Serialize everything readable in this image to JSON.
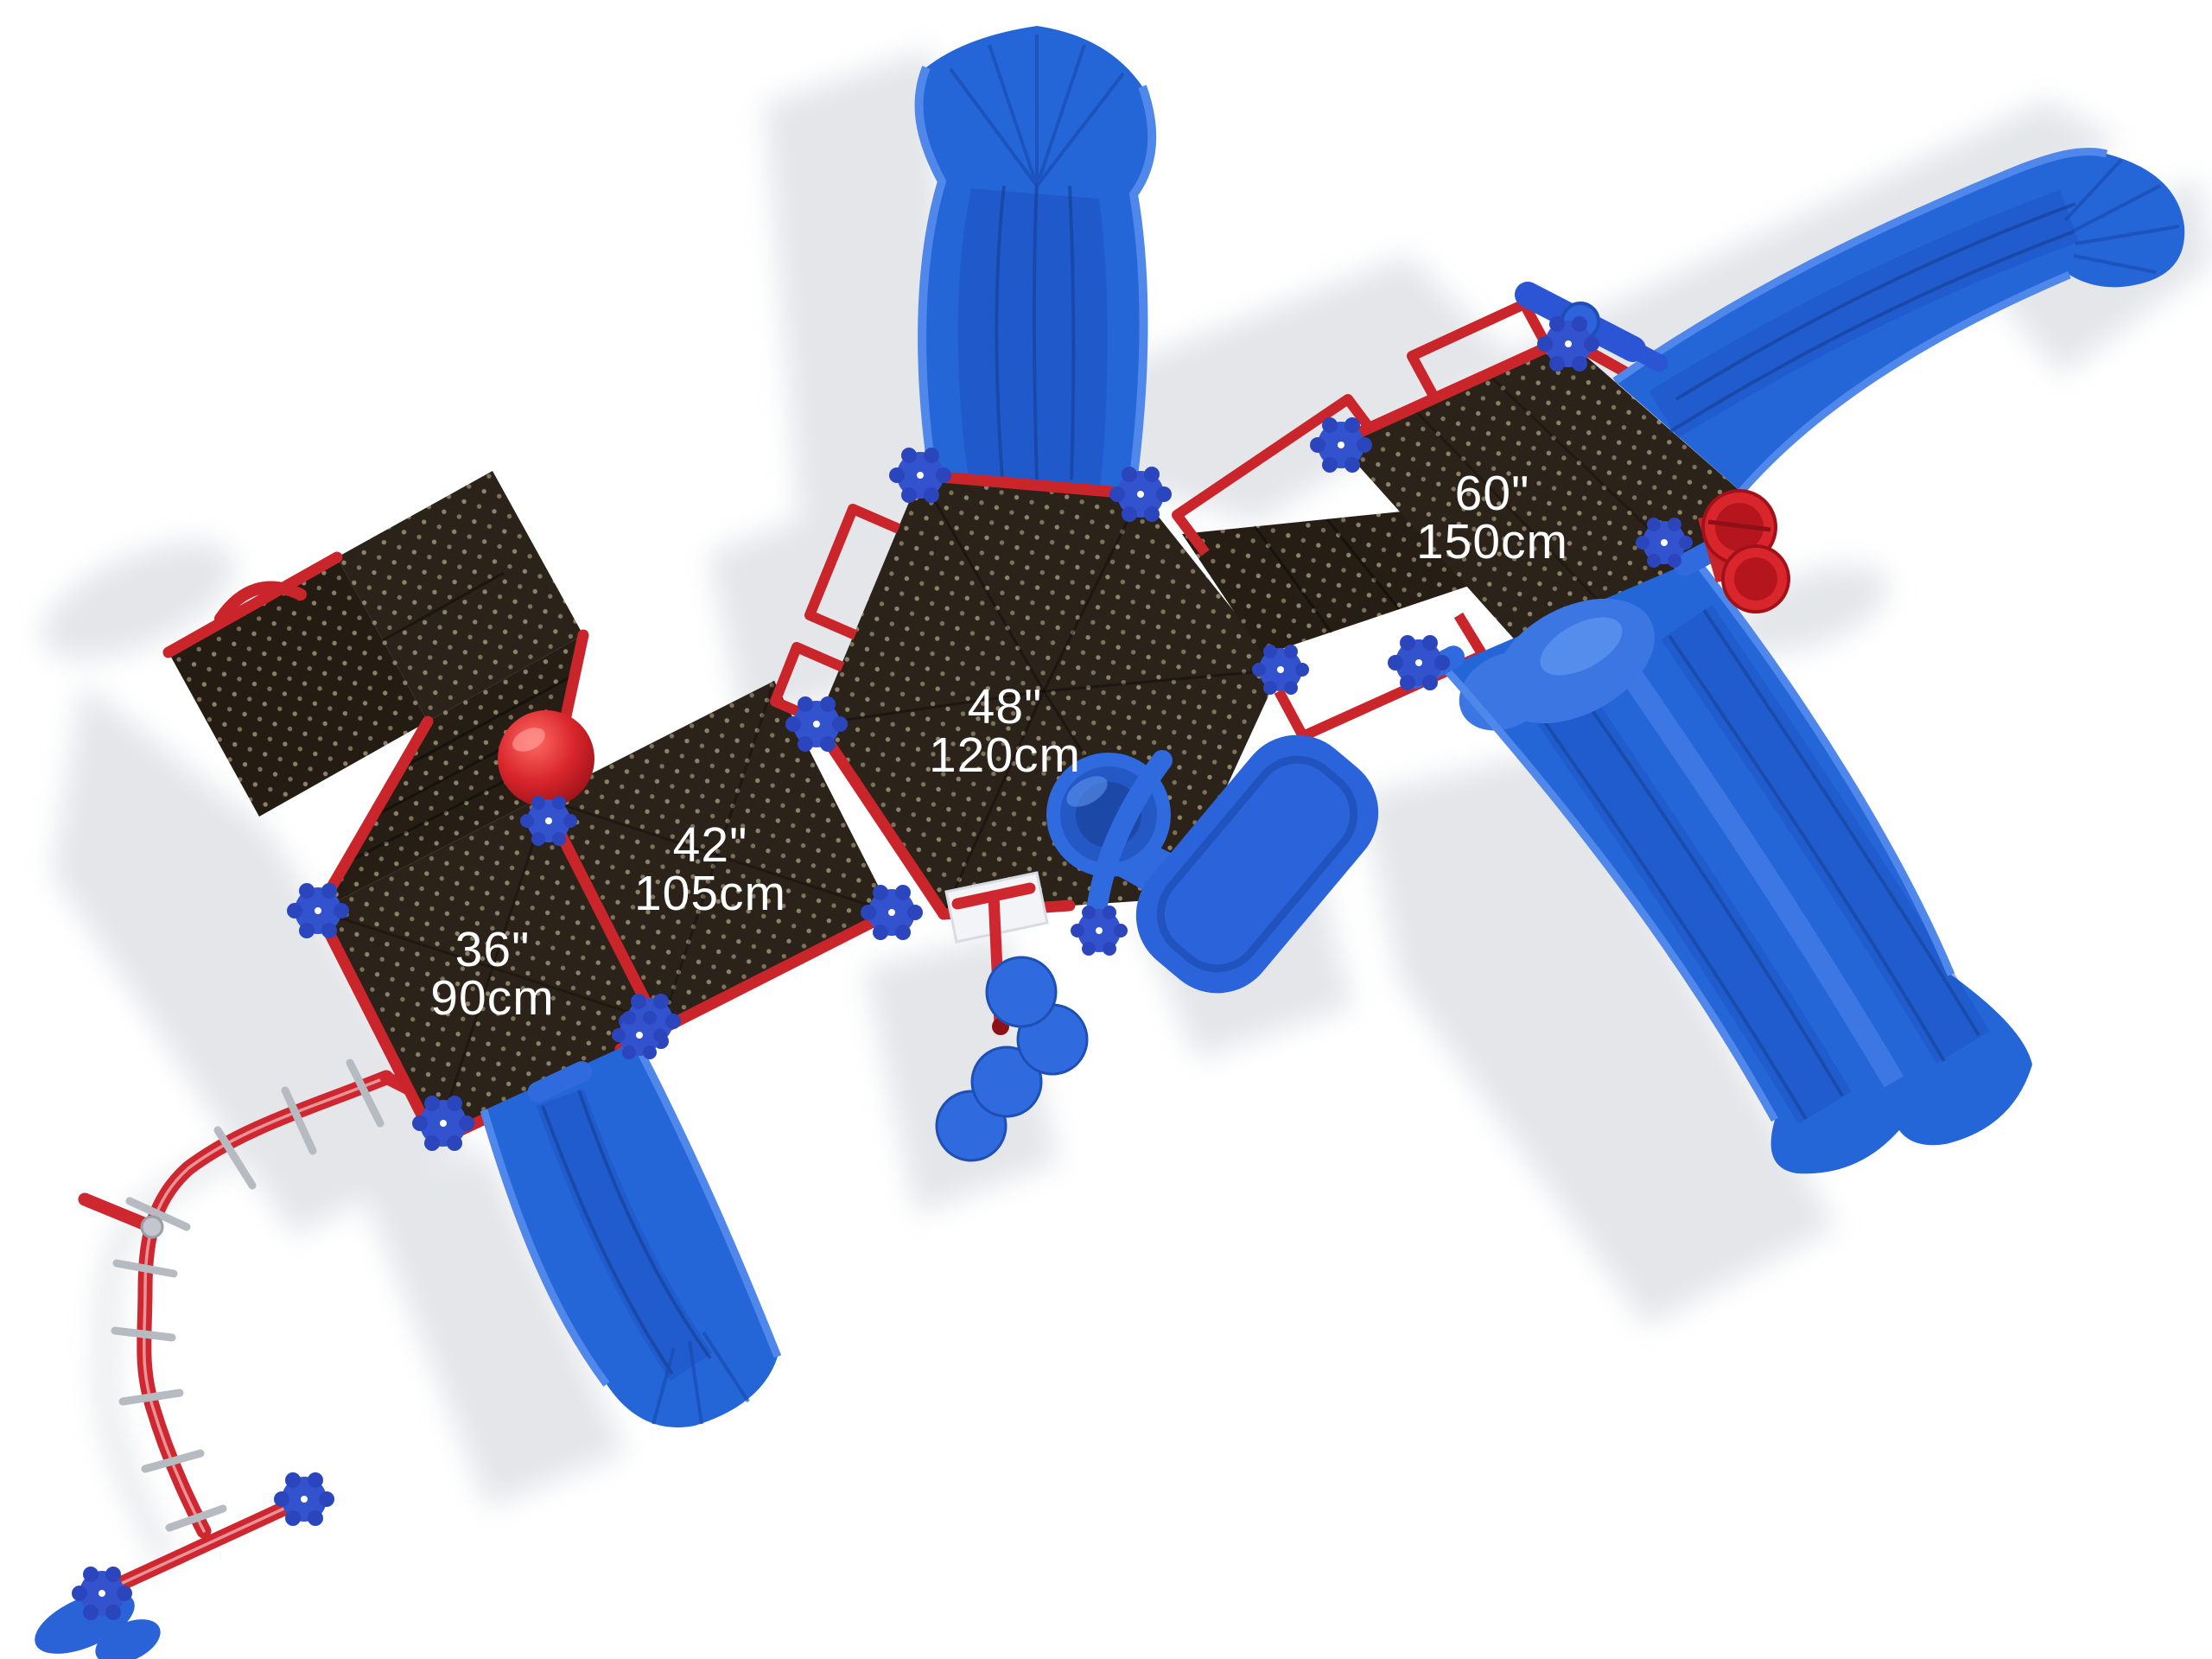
{
  "scene": {
    "type": "playground-structure-top-view",
    "background": "#ffffff"
  },
  "platforms": [
    {
      "name": "deck-36",
      "height_inches": "36\"",
      "height_cm": "90cm"
    },
    {
      "name": "deck-42",
      "height_inches": "42\"",
      "height_cm": "105cm"
    },
    {
      "name": "deck-48-hex",
      "height_inches": "48\"",
      "height_cm": "120cm"
    },
    {
      "name": "deck-60",
      "height_inches": "60\"",
      "height_cm": "150cm"
    }
  ],
  "colors": {
    "deck_brown": "#2b2219",
    "deck_perforation": "#d9c49a",
    "rail_red": "#c9252b",
    "slide_blue": "#2465d8",
    "slide_blue_deep": "#1b4fb5",
    "slide_blue_light": "#4f87ea",
    "post_cap_blue": "#3351cd",
    "accent_red": "#d4282e",
    "metal_gray": "#b6bac1",
    "shadow_gray": "#d2d6dc",
    "label_text": "#ffffff"
  }
}
